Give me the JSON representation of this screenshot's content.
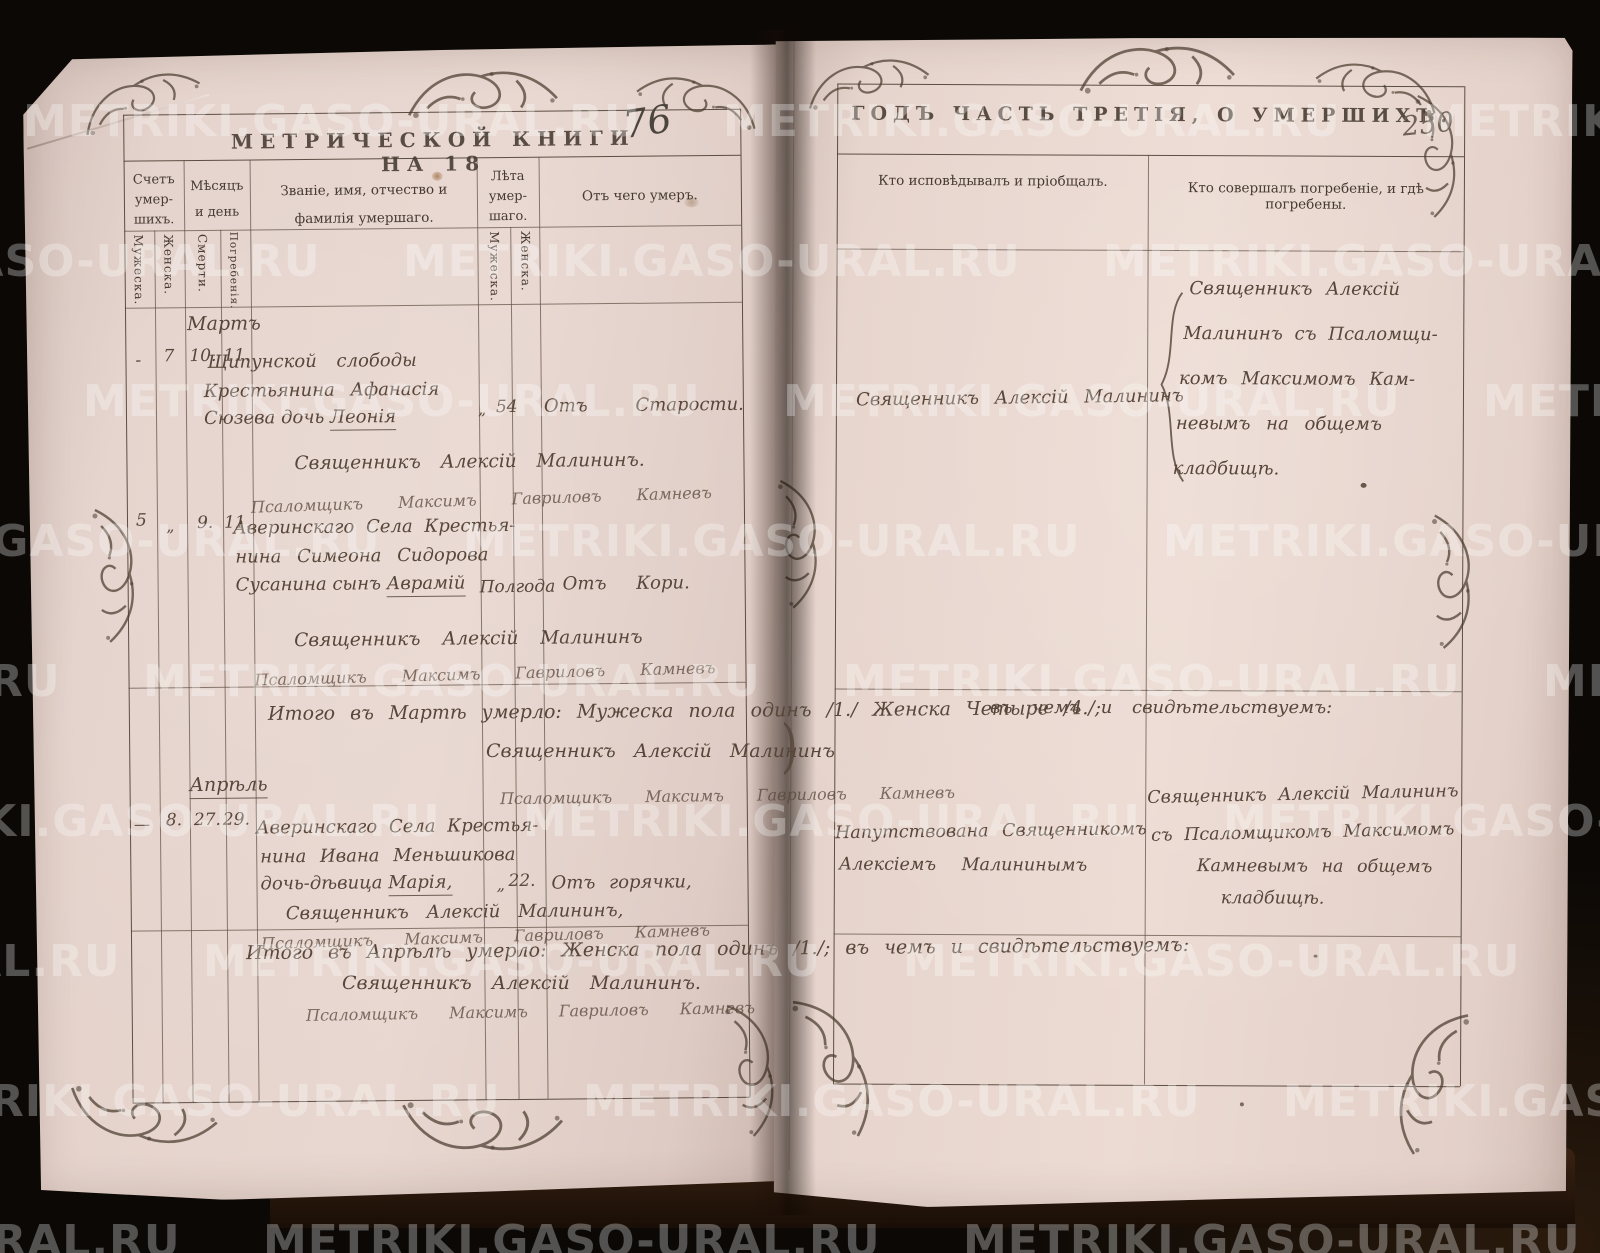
{
  "watermark": {
    "text": "METRIKI.GASO-URAL.RU"
  },
  "left_page": {
    "title": {
      "printed": "МЕТРИЧЕСКОЙ КНИГИ НА 18",
      "year_handwritten": "76"
    },
    "columns": {
      "count_label": "Счетъ умер- шихъ.",
      "count_male": "Мужеска.",
      "count_female": "Женска.",
      "date_label": "Мѣсяцъ и день",
      "date_death": "Смерти.",
      "date_burial": "Погребенія.",
      "name_label": "Званіе, имя, отчество и фамилія умершаго.",
      "age_label": "Лѣта умер- шаго.",
      "age_male": "Мужеска.",
      "age_female": "Женска.",
      "cause_label": "Отъ чего умеръ."
    },
    "march": {
      "month": "Мартъ",
      "entry1": {
        "count_male": "-",
        "count_female": "7",
        "day_death": "10.",
        "day_burial": "11.",
        "line1": "Щипунской слободы",
        "line2": "Крестьянина Афанасія",
        "line3_prefix": "Сюзева дочь ",
        "name": "Леонія",
        "age_mark": "„",
        "age_female": "54",
        "cause": "Отъ Старости.",
        "priest": "Священникъ Алексій Малининъ.",
        "psalmist": "Псаломщикъ Максимъ Гавриловъ Камневъ"
      },
      "entry2": {
        "count_male": "5",
        "count_female": "„",
        "day_death": "9.",
        "day_burial": "11.",
        "line1": "Аверинскаго Села Крестья-",
        "line2": "нина Симеона Сидорова",
        "line3_prefix": "Сусанина сынъ ",
        "name": "Аврамій",
        "age_inline": "Полгода",
        "cause": "Отъ Кори.",
        "priest": "Священникъ Алексій Малининъ",
        "psalmist": "Псаломщикъ Максимъ Гавриловъ Камневъ"
      },
      "total": {
        "line1": "Итого въ Мартѣ умерло: Мужеска пола одинъ /1./ Женска Четыре /4./;",
        "line2": "въ чемъ и свидѣтельствуемъ:",
        "priest": "Священникъ Алексій Малининъ",
        "closing_brace": ")",
        "psalmist": "Псаломщикъ Максимъ Гавриловъ Камневъ"
      }
    },
    "april": {
      "month": "Апрѣль",
      "entry1": {
        "count_male": "—",
        "count_female": "8.",
        "day_death": "27.",
        "day_burial": "29.",
        "line1": "Аверинскаго Села Крестья-",
        "line2": "нина Ивана Меньшикова",
        "line3_prefix": "дочь-дѣвица ",
        "name": "Марія,",
        "age_mark": "„",
        "age_female": "22.",
        "cause": "Отъ горячки,",
        "priest": "Священникъ Алексій Малининъ,",
        "psalmist": "Псаломщикъ Максимъ Гавриловъ Камневъ"
      },
      "total": {
        "line1": "Итого въ Апрѣлѣ умерло: Женска пола одинъ /1./; въ чемъ и свидѣтельствуемъ:",
        "priest": "Священникъ Алексій Малининъ.",
        "psalmist": "Псаломщикъ Максимъ Гавриловъ Камневъ"
      }
    }
  },
  "right_page": {
    "title": "ГОДЪ ЧАСТЬ ТРЕТІЯ, О УМЕРШИХЪ.",
    "page_number": "250",
    "columns": {
      "confession": "Кто исповѣдывалъ и пріобщалъ.",
      "burial": "Кто совершалъ погребеніе, и гдѣ погребены."
    },
    "march": {
      "confession": "Священникъ Алексій Малининъ",
      "burial_lines": [
        "Священникъ Алексій",
        "Малининъ съ Псаломщи-",
        "комъ Максимомъ Кам-",
        "невымъ на общемъ",
        "кладбищѣ."
      ]
    },
    "april": {
      "confession_lines": [
        "Напутствована Священникомъ",
        "Алексіемъ Малининымъ"
      ],
      "burial_lines": [
        "Священникъ Алексій Малининъ",
        "съ Псаломщикомъ Максимомъ",
        "Камневымъ на общемъ",
        "кладбищѣ."
      ]
    }
  }
}
